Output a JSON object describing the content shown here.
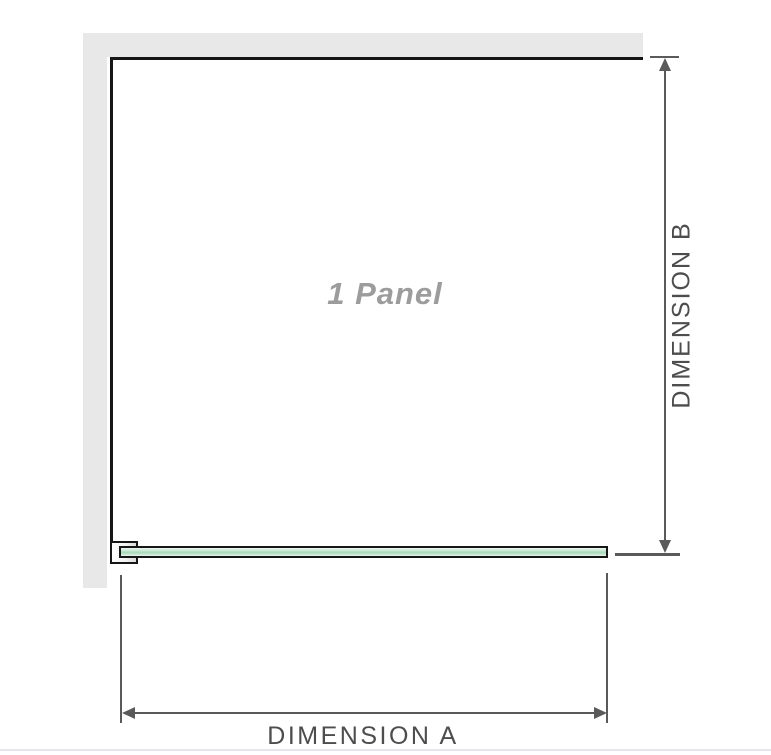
{
  "diagram": {
    "panel_label": "1 Panel",
    "dimension_a_label": "DIMENSION A",
    "dimension_b_label": "DIMENSION B"
  },
  "colors": {
    "wall": "#e8e8e8",
    "outline": "#161616",
    "dimension": "#5a5a5a",
    "label_text": "#4d4d4d",
    "panel_label_text": "#9c9c9c",
    "glass_green": "#a9d9ba",
    "glass_green_light": "#eaf6ee",
    "baseline": "#e6e6ea"
  }
}
